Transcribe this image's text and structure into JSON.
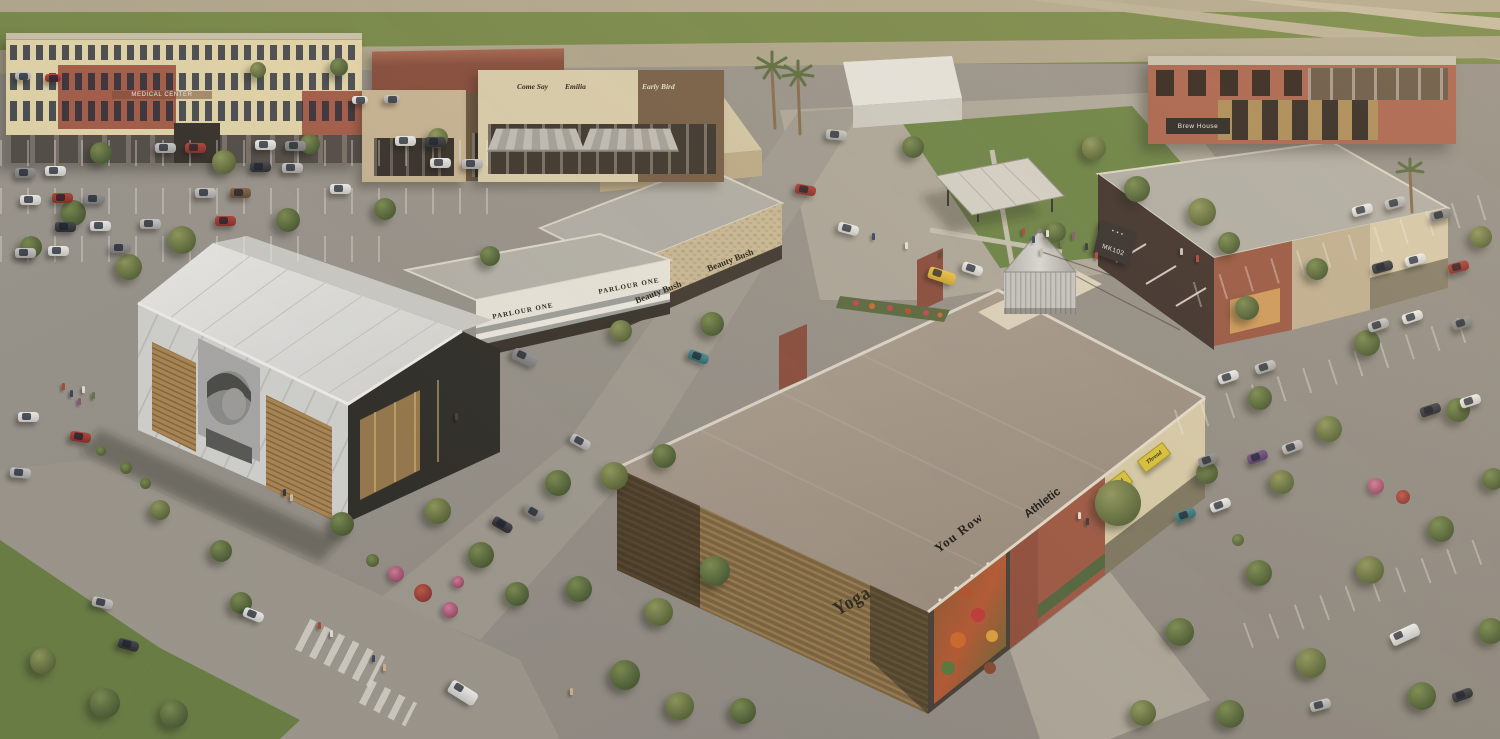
{
  "scene": {
    "type": "aerial architectural rendering",
    "subject": "open-air retail and mixed-use shopping center with parking lots, central green, event barn, water tower and flower mural",
    "time_of_day": "late afternoon sun from the right"
  },
  "signs": {
    "medical_center": "MEDICAL CENTER",
    "shop_a": "Come Say",
    "shop_b": "Emilia",
    "shop_c": "Early Bird",
    "parlour_one": "PARLOUR ONE",
    "beauty_bush": "Beauty Bush",
    "brew_house": "Brew House",
    "mk102": "MK102",
    "yoga": "Yoga",
    "you_row": "You Row",
    "athletic": "Athletic",
    "thread": "Thread"
  },
  "colors": {
    "asphalt": "#99948c",
    "field_green": "#7c8c4c",
    "lawn_green": "#6e8547",
    "tree_green": "#5a6a3c",
    "brick_red": "#a8604a",
    "cream_stucco": "#ddd0ad",
    "barn_white": "#e6e5e1",
    "roof_gray": "#b5b1a8",
    "roof_tan": "#a79a8b",
    "wood_slat": "#8a6f48",
    "awning_green": "#55683e",
    "sign_yellow": "#d9c53a",
    "water_tower_silver": "#c9c7c2",
    "mural_flower_orange": "#d06a2c"
  }
}
